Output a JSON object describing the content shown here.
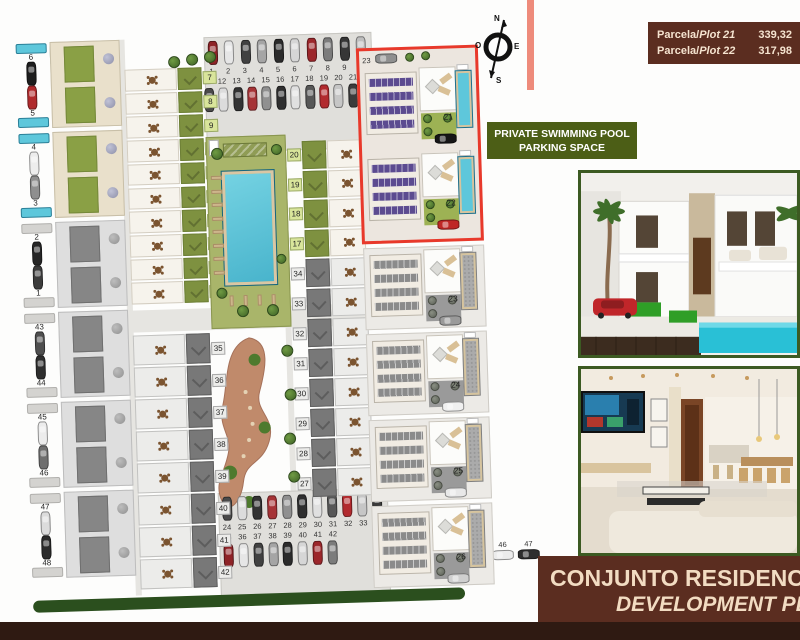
{
  "colors": {
    "highlight": "#e8392b",
    "pool": "#5ec7db",
    "panel": "#5c4b90",
    "roof_green": "#7e9140",
    "badge_green": "#4c5e16",
    "maroon": "#5b2d20",
    "maroon_dark": "#2f1a12"
  },
  "plots_badge": {
    "rows": [
      {
        "prefix": "Parcela/",
        "plot": "Plot 21",
        "value": "339,32"
      },
      {
        "prefix": "Parcela/",
        "plot": "Plot 22",
        "value": "317,98"
      }
    ]
  },
  "compass": {
    "n": "N",
    "s": "S",
    "e": "E",
    "o": "O"
  },
  "feature_badge": {
    "line1": "PRIVATE SWIMMING POOL",
    "line2": "PARKING SPACE"
  },
  "banner": {
    "line1": "CONJUNTO RESIDENCIAL",
    "line2": "DEVELOPMENT PLAN"
  },
  "plan": {
    "top_parking_row1": [
      "1",
      "2",
      "3",
      "4",
      "5",
      "6",
      "7",
      "8",
      "9",
      "10"
    ],
    "top_parking_row2": [
      "11",
      "12",
      "13",
      "14",
      "15",
      "16",
      "17",
      "18",
      "19",
      "20",
      "21",
      "22"
    ],
    "bottom_parking_row1": [
      "24",
      "25",
      "26",
      "27",
      "28",
      "29",
      "30",
      "31",
      "32",
      "33",
      "34"
    ],
    "bottom_parking_row2": [
      "35",
      "36",
      "37",
      "38",
      "39",
      "40",
      "41",
      "42"
    ],
    "bottom_parking_row3": [
      "43",
      "44",
      "45",
      "46",
      "47"
    ],
    "side_car_colors": [
      "#f0f0f0",
      "#3a3a3a",
      "#b42528",
      "#ececec",
      "#2e2e2e"
    ],
    "car_palette": [
      "#8e2327",
      "#e6e6e6",
      "#414141",
      "#a5a5a5",
      "#2b2b2b",
      "#d6d6d6",
      "#9c272b",
      "#7c7c7c",
      "#363636",
      "#bfbfbf",
      "#4c4c4c",
      "#cccccc"
    ],
    "car_palette2": [
      "#4a4a4a",
      "#dcdcdc",
      "#333333",
      "#a63336",
      "#909090",
      "#2f2f2f",
      "#e0e0e0",
      "#575757",
      "#b22a2e",
      "#c6c6c6",
      "#3b3b3b",
      "#8a8a8a"
    ],
    "left_blocks": [
      {
        "top": "6",
        "bottom": "5",
        "scheme": "color",
        "cars": [
          "#1d1d1d",
          "#b02a2c"
        ]
      },
      {
        "top": "4",
        "bottom": "3",
        "scheme": "color",
        "cars": [
          "#ededed",
          "#8f8f8f"
        ]
      },
      {
        "top": "2",
        "bottom": "1",
        "scheme": "gray",
        "cars": [
          "#262626",
          "#3c3c3c"
        ]
      },
      {
        "top": "43",
        "bottom": "44",
        "scheme": "gray",
        "cars": [
          "#4f4f4f",
          "#2e2e2e"
        ]
      },
      {
        "top": "45",
        "bottom": "46",
        "scheme": "gray",
        "cars": [
          "#ececec",
          "#6f6f6f"
        ]
      },
      {
        "top": "47",
        "bottom": "48",
        "scheme": "gray",
        "cars": [
          "#dcdcdc",
          "#2b2b2b"
        ]
      }
    ],
    "mid_left_rows": [
      {
        "label": "7",
        "scheme": "color"
      },
      {
        "label": "8",
        "scheme": "color"
      },
      {
        "label": "9",
        "scheme": "color"
      },
      {
        "label": "10",
        "scheme": "color"
      },
      {
        "label": "11",
        "scheme": "color"
      },
      {
        "label": "12",
        "scheme": "color"
      },
      {
        "label": "13",
        "scheme": "color"
      },
      {
        "label": "14",
        "scheme": "color"
      },
      {
        "label": "15",
        "scheme": "color"
      },
      {
        "label": "16",
        "scheme": "color"
      },
      {
        "label": "35",
        "scheme": "gray"
      },
      {
        "label": "36",
        "scheme": "gray"
      },
      {
        "label": "37",
        "scheme": "gray"
      },
      {
        "label": "38",
        "scheme": "gray"
      },
      {
        "label": "39",
        "scheme": "gray"
      },
      {
        "label": "40",
        "scheme": "gray"
      },
      {
        "label": "41",
        "scheme": "gray"
      },
      {
        "label": "42",
        "scheme": "gray"
      }
    ],
    "mid_right_rows": [
      {
        "label": "20",
        "scheme": "color"
      },
      {
        "label": "19",
        "scheme": "color"
      },
      {
        "label": "18",
        "scheme": "color"
      },
      {
        "label": "17",
        "scheme": "color"
      },
      {
        "label": "34",
        "scheme": "gray"
      },
      {
        "label": "33",
        "scheme": "gray"
      },
      {
        "label": "32",
        "scheme": "gray"
      },
      {
        "label": "31",
        "scheme": "gray"
      },
      {
        "label": "30",
        "scheme": "gray"
      },
      {
        "label": "29",
        "scheme": "gray"
      },
      {
        "label": "28",
        "scheme": "gray"
      },
      {
        "label": "27",
        "scheme": "gray"
      }
    ],
    "highlight_zone": {
      "parking_label": "23",
      "villas": [
        {
          "label": "21",
          "car": "#161616"
        },
        {
          "label": "22",
          "car": "#bf2725"
        }
      ]
    },
    "gray_villas": [
      {
        "label": "23",
        "car": "#9a9a9a"
      },
      {
        "label": "24",
        "car": "#f0f0f0"
      },
      {
        "label": "25",
        "car": "#e8e8e8"
      },
      {
        "label": "26",
        "car": "#cfcfcf"
      }
    ]
  }
}
